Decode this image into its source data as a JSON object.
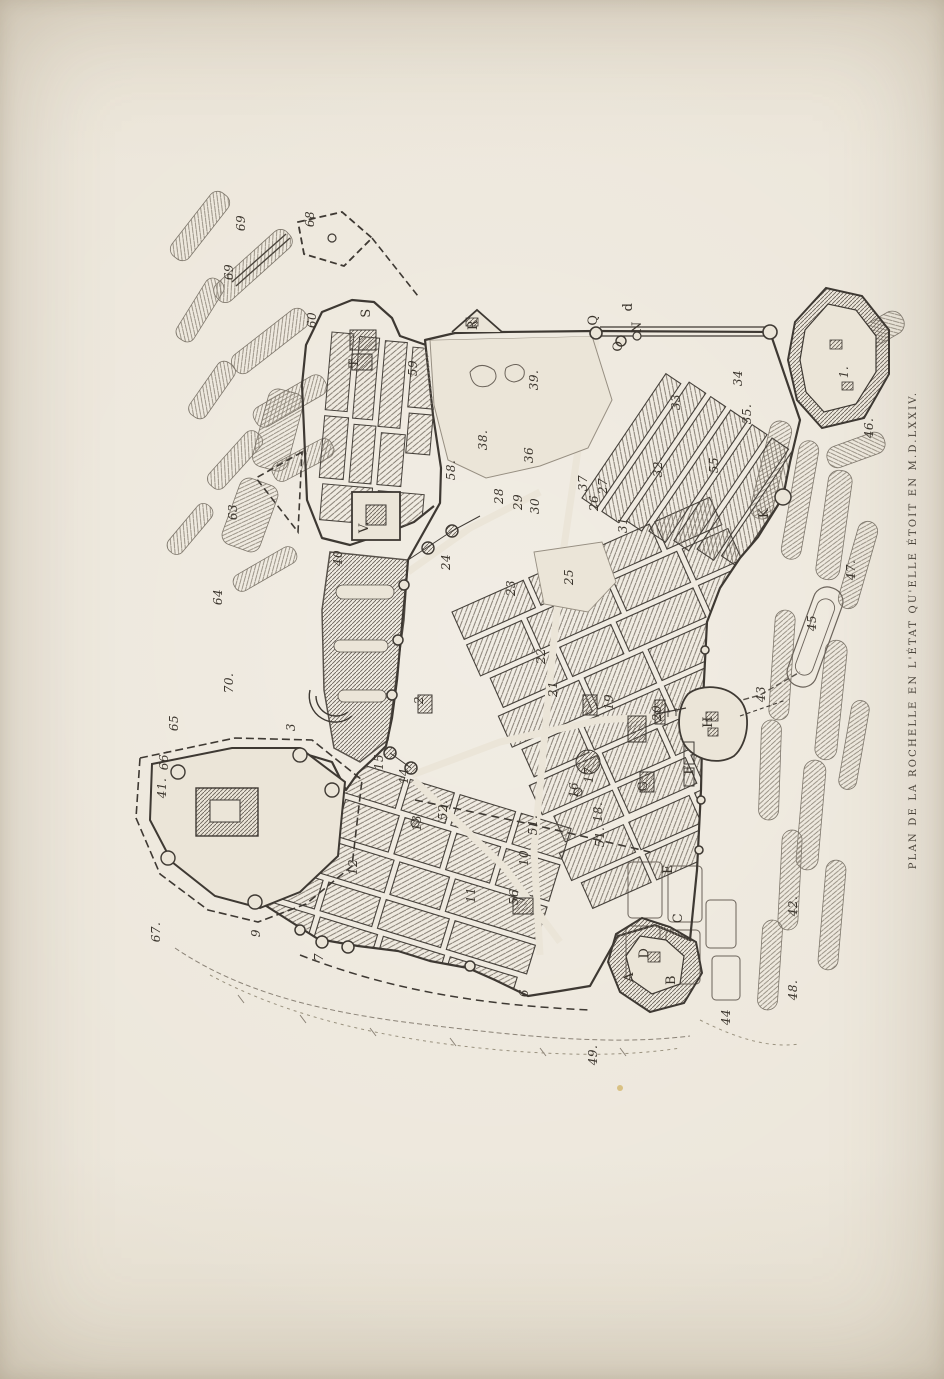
{
  "page": {
    "title_vertical": "PLAN DE LA ROCHELLE EN L'ÉTAT QU'ELLE ÉTOIT EN M.D.LXXIV."
  },
  "colors": {
    "paper": "#ebe5d8",
    "paper_edge": "#d9d2c3",
    "ink": "#3e3933",
    "hatch": "#7a7267",
    "marsh_hatch": "#8b8377",
    "label_ink": "#3a342c"
  },
  "map": {
    "labels": [
      {
        "t": "69",
        "x": 233,
        "y": 272
      },
      {
        "t": "69",
        "x": 245,
        "y": 223
      },
      {
        "t": "68",
        "x": 314,
        "y": 219
      },
      {
        "t": "60",
        "x": 316,
        "y": 320
      },
      {
        "t": "59",
        "x": 417,
        "y": 368
      },
      {
        "t": "58.",
        "x": 455,
        "y": 470
      },
      {
        "t": "T",
        "x": 358,
        "y": 363,
        "k": "letter"
      },
      {
        "t": "S",
        "x": 370,
        "y": 313,
        "k": "letter"
      },
      {
        "t": "R",
        "x": 477,
        "y": 325,
        "k": "letter"
      },
      {
        "t": "V.",
        "x": 368,
        "y": 527,
        "k": "letter"
      },
      {
        "t": "Q",
        "x": 597,
        "y": 320,
        "k": "letter"
      },
      {
        "t": "d",
        "x": 632,
        "y": 307,
        "k": "letter"
      },
      {
        "t": "N",
        "x": 641,
        "y": 327,
        "k": "letter"
      },
      {
        "t": "O",
        "x": 622,
        "y": 346,
        "k": "letter"
      },
      {
        "t": "63",
        "x": 237,
        "y": 512
      },
      {
        "t": "64",
        "x": 222,
        "y": 597
      },
      {
        "t": "70.",
        "x": 233,
        "y": 683
      },
      {
        "t": "65",
        "x": 178,
        "y": 723
      },
      {
        "t": "66.",
        "x": 168,
        "y": 760
      },
      {
        "t": "41.",
        "x": 166,
        "y": 788
      },
      {
        "t": "67.",
        "x": 160,
        "y": 932
      },
      {
        "t": "40",
        "x": 342,
        "y": 558
      },
      {
        "t": "39.",
        "x": 538,
        "y": 380
      },
      {
        "t": "38.",
        "x": 487,
        "y": 440
      },
      {
        "t": "36",
        "x": 533,
        "y": 455
      },
      {
        "t": "37",
        "x": 587,
        "y": 483
      },
      {
        "t": "27",
        "x": 607,
        "y": 486
      },
      {
        "t": "26",
        "x": 598,
        "y": 503
      },
      {
        "t": "28",
        "x": 503,
        "y": 496
      },
      {
        "t": "29",
        "x": 522,
        "y": 502
      },
      {
        "t": "30",
        "x": 539,
        "y": 506
      },
      {
        "t": "31",
        "x": 627,
        "y": 525
      },
      {
        "t": "32.",
        "x": 662,
        "y": 467
      },
      {
        "t": "33",
        "x": 680,
        "y": 402
      },
      {
        "t": "34",
        "x": 742,
        "y": 378
      },
      {
        "t": "35.",
        "x": 751,
        "y": 414
      },
      {
        "t": "55",
        "x": 718,
        "y": 465
      },
      {
        "t": "1.",
        "x": 848,
        "y": 372
      },
      {
        "t": "46.",
        "x": 873,
        "y": 428
      },
      {
        "t": "47.",
        "x": 855,
        "y": 570
      },
      {
        "t": "45",
        "x": 816,
        "y": 623
      },
      {
        "t": "43",
        "x": 765,
        "y": 694
      },
      {
        "t": "K",
        "x": 768,
        "y": 513,
        "k": "letter"
      },
      {
        "t": "24",
        "x": 450,
        "y": 562
      },
      {
        "t": "23",
        "x": 515,
        "y": 588
      },
      {
        "t": "25",
        "x": 573,
        "y": 577
      },
      {
        "t": "22",
        "x": 545,
        "y": 656
      },
      {
        "t": "21",
        "x": 557,
        "y": 689
      },
      {
        "t": "19",
        "x": 613,
        "y": 702
      },
      {
        "t": "20",
        "x": 661,
        "y": 713
      },
      {
        "t": "2",
        "x": 423,
        "y": 700
      },
      {
        "t": "3",
        "x": 295,
        "y": 727
      },
      {
        "t": "15",
        "x": 383,
        "y": 762
      },
      {
        "t": "14",
        "x": 408,
        "y": 776
      },
      {
        "t": "13",
        "x": 421,
        "y": 823
      },
      {
        "t": "52.",
        "x": 447,
        "y": 810
      },
      {
        "t": "51.",
        "x": 537,
        "y": 825
      },
      {
        "t": "51.",
        "x": 604,
        "y": 837
      },
      {
        "t": "17",
        "x": 593,
        "y": 775
      },
      {
        "t": "16",
        "x": 578,
        "y": 790
      },
      {
        "t": "18.",
        "x": 602,
        "y": 812
      },
      {
        "t": "12",
        "x": 357,
        "y": 867
      },
      {
        "t": "10",
        "x": 528,
        "y": 858
      },
      {
        "t": "11",
        "x": 475,
        "y": 895
      },
      {
        "t": "56",
        "x": 518,
        "y": 897
      },
      {
        "t": "9",
        "x": 260,
        "y": 933
      },
      {
        "t": "7",
        "x": 323,
        "y": 957
      },
      {
        "t": "6",
        "x": 528,
        "y": 993
      },
      {
        "t": "H",
        "x": 712,
        "y": 722,
        "k": "letter"
      },
      {
        "t": "F",
        "x": 693,
        "y": 770,
        "k": "letter"
      },
      {
        "t": "G",
        "x": 647,
        "y": 786,
        "k": "letter"
      },
      {
        "t": "E",
        "x": 672,
        "y": 869,
        "k": "letter"
      },
      {
        "t": "C",
        "x": 682,
        "y": 918,
        "k": "letter"
      },
      {
        "t": "D",
        "x": 648,
        "y": 953,
        "k": "letter"
      },
      {
        "t": "A",
        "x": 633,
        "y": 977,
        "k": "letter"
      },
      {
        "t": "B",
        "x": 675,
        "y": 980,
        "k": "letter"
      },
      {
        "t": "42.",
        "x": 797,
        "y": 906
      },
      {
        "t": "48.",
        "x": 797,
        "y": 990
      },
      {
        "t": "44",
        "x": 730,
        "y": 1017
      },
      {
        "t": "49.",
        "x": 597,
        "y": 1055
      }
    ]
  }
}
